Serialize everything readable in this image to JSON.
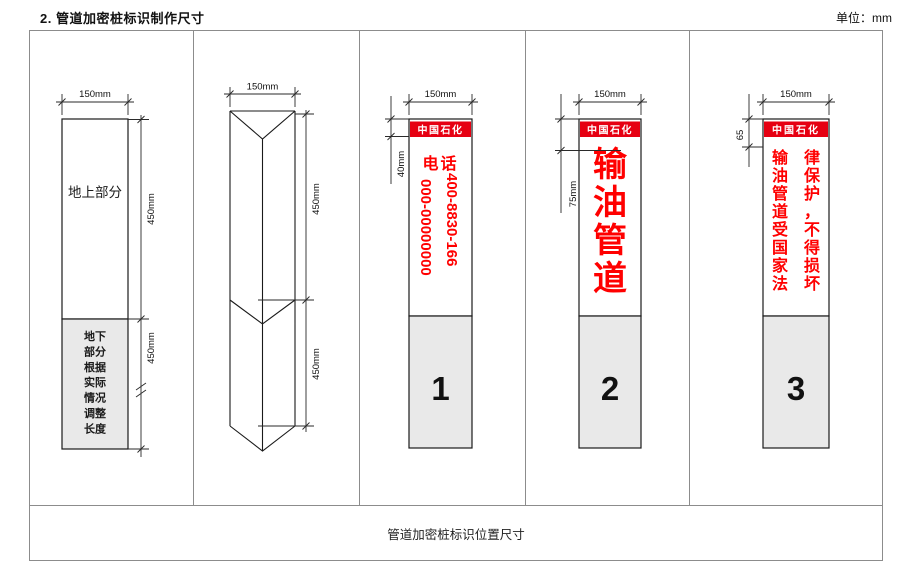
{
  "page": {
    "title": "2. 管道加密桩标识制作尺寸",
    "unit_label": "单位：mm",
    "footer_label": "管道加密桩标识位置尺寸"
  },
  "colors": {
    "banner_red": "#e60012",
    "text_red": "#ff0000",
    "underground_gray": "#e9e9e9",
    "grid_border_gray": "#8c8c8c"
  },
  "panel_rect": {
    "width_dim": "150mm",
    "upper_height_dim": "450mm",
    "lower_height_dim": "450mm",
    "above_ground_label": "地上部分",
    "below_ground_lines": [
      "地下",
      "部分",
      "根据",
      "实际",
      "情况",
      "调整",
      "长度"
    ]
  },
  "panel_prism": {
    "width_dim": "150mm",
    "upper_height_dim": "450mm",
    "lower_height_dim": "450mm"
  },
  "panel_phone": {
    "width_dim": "150mm",
    "banner_height_dim": "40mm",
    "brand": "中国石化",
    "phone_label": "电话",
    "phone_number_left": "000-00000000",
    "phone_number_right": "400-8830-166",
    "index_number": "1"
  },
  "panel_pipeline": {
    "width_dim": "150mm",
    "banner_height_dim": "75mm",
    "brand": "中国石化",
    "chars": [
      "输",
      "油",
      "管",
      "道"
    ],
    "index_number": "2"
  },
  "panel_warning": {
    "width_dim": "150mm",
    "banner_height_dim": "65",
    "brand": "中国石化",
    "left_chars": [
      "输",
      "油",
      "管",
      "道",
      "受",
      "国",
      "家",
      "法"
    ],
    "right_chars": [
      "律",
      "保",
      "护",
      "，",
      "不",
      "得",
      "损",
      "坏"
    ],
    "index_number": "3"
  }
}
